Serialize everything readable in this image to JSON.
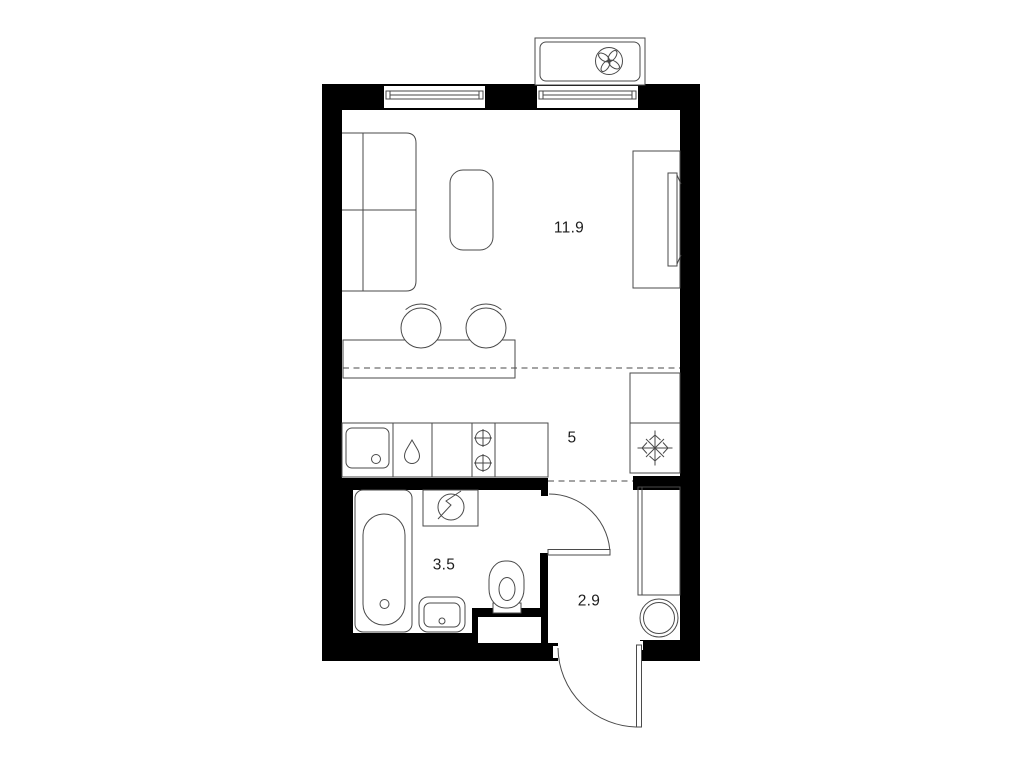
{
  "plan": {
    "background": "#ffffff",
    "wall_color": "#000000",
    "line_color": "#4a4a4a",
    "text_color": "#1c1c1c",
    "rooms": {
      "living": {
        "area": "11.9"
      },
      "kitchen": {
        "area": "5"
      },
      "bathroom": {
        "area": "3.5"
      },
      "hallway": {
        "area": "2.9"
      }
    },
    "icons": {
      "ac_unit": "four-blade-fan",
      "fridge": "snowflake",
      "washing_machine": "drum-with-slash",
      "stove": "two-burner-rings",
      "kitchen_faucet": "water-drop",
      "water_heater": "double-circle"
    }
  }
}
